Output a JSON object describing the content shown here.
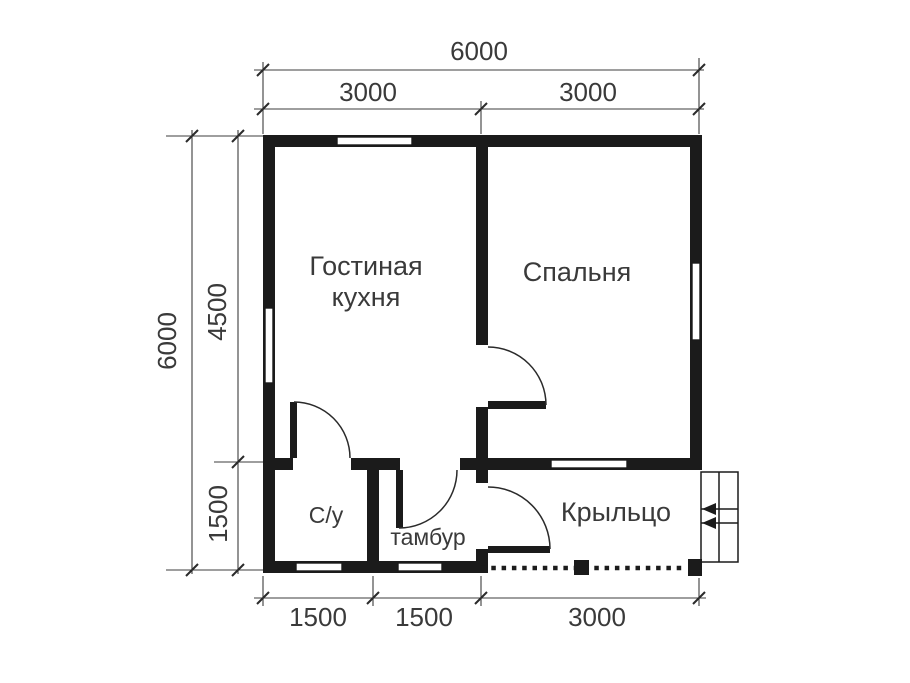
{
  "plan": {
    "type": "floor-plan",
    "rooms": {
      "living_kitchen_line1": "Гостиная",
      "living_kitchen_line2": "кухня",
      "bedroom": "Спальня",
      "bathroom": "С/у",
      "vestibule": "тамбур",
      "porch": "Крыльцо"
    },
    "dims": {
      "top_overall": "6000",
      "top_left": "3000",
      "top_right": "3000",
      "side_overall": "6000",
      "side_upper": "4500",
      "side_lower": "1500",
      "bottom_left": "1500",
      "bottom_mid": "1500",
      "bottom_right": "3000"
    },
    "stairs": {
      "direction_icon": "left-arrow-icon",
      "steps": 2
    },
    "colors": {
      "wall": "#1b1b1b",
      "dimension_line": "#3d3d3d",
      "text": "#3a3a3a",
      "background": "#ffffff"
    }
  }
}
